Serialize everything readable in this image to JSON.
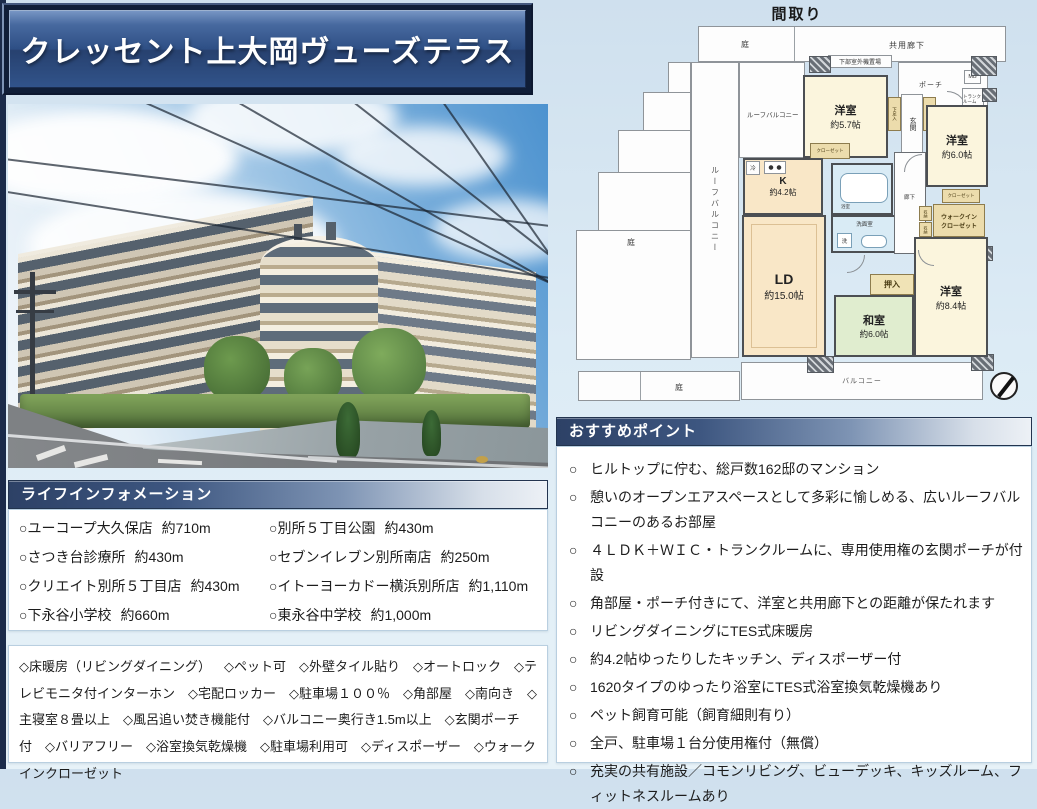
{
  "title_banner": "クレッセント上大岡ヴューズテラス",
  "floorplan": {
    "title": "間取り",
    "labels": {
      "garden": "庭",
      "common_corridor": "共用廊下",
      "outdoor_unit": "下部室外機置場",
      "porch": "ポーチ",
      "mb": "MB",
      "trunk_room": "トランクルーム",
      "roof_balcony": "ルーフバルコニー",
      "balcony": "バルコニー",
      "entrance": "玄関",
      "shoe_box": "下足入",
      "hallway": "廊下",
      "toilet": "トイレ",
      "bath": "浴室",
      "washroom": "洗面室",
      "washer": "洗",
      "fridge": "冷",
      "storage": "収納",
      "closet": "クローゼット",
      "wic_line1": "ウォークイン",
      "wic_line2": "クローゼット",
      "oshiire": "押入"
    },
    "rooms": {
      "western1": {
        "name": "洋室",
        "size": "約5.7帖"
      },
      "western2": {
        "name": "洋室",
        "size": "約6.0帖"
      },
      "western3": {
        "name": "洋室",
        "size": "約8.4帖"
      },
      "japanese": {
        "name": "和室",
        "size": "約6.0帖"
      },
      "kitchen": {
        "name": "K",
        "size": "約4.2帖"
      },
      "ld": {
        "name": "LD",
        "size": "約15.0帖"
      }
    }
  },
  "life_info": {
    "header": "ライフインフォメーション",
    "bullet": "○",
    "left": [
      {
        "name": "ユーコープ大久保店",
        "distance": "約710m"
      },
      {
        "name": "さつき台診療所",
        "distance": "約430m"
      },
      {
        "name": "クリエイト別所５丁目店",
        "distance": "約430m"
      },
      {
        "name": "下永谷小学校",
        "distance": "約660m"
      }
    ],
    "right": [
      {
        "name": "別所５丁目公園",
        "distance": "約430m"
      },
      {
        "name": "セブンイレブン別所南店",
        "distance": "約250m"
      },
      {
        "name": "イトーヨーカドー横浜別所店",
        "distance": "約1,110m"
      },
      {
        "name": "東永谷中学校",
        "distance": "約1,000m"
      }
    ]
  },
  "features": {
    "items": [
      "◇床暖房（リビングダイニング）",
      "◇ペット可",
      "◇外壁タイル貼り",
      "◇オートロック",
      "◇テレビモニタ付インターホン",
      "◇宅配ロッカー",
      "◇駐車場１００％",
      "◇角部屋",
      "◇南向き",
      "◇主寝室８畳以上",
      "◇風呂追い焚き機能付",
      "◇バルコニー奥行き1.5m以上",
      "◇玄関ポーチ付",
      "◇バリアフリー",
      "◇浴室換気乾燥機",
      "◇駐車場利用可",
      "◇ディスポーザー",
      "◇ウォークインクローゼット"
    ]
  },
  "recommend": {
    "header": "おすすめポイント",
    "bullet": "○",
    "points": [
      "ヒルトップに佇む、総戸数162邸のマンション",
      "憩いのオープンエアスペースとして多彩に愉しめる、広いルーフバルコニーのあるお部屋",
      "４ＬＤＫ＋ＷＩＣ・トランクルームに、専用使用権の玄関ポーチが付設",
      "角部屋・ポーチ付きにて、洋室と共用廊下との距離が保たれます",
      "リビングダイニングにTES式床暖房",
      "約4.2帖ゆったりしたキッチン、ディスポーザー付",
      "1620タイプのゆったり浴室にTES式浴室換気乾燥機あり",
      "ペット飼育可能（飼育細則有り）",
      "全戸、駐車場１台分使用権付（無償）",
      "充実の共有施設／コモンリビング、ビューデッキ、キッズルーム、フィットネスルームあり"
    ]
  },
  "colors": {
    "accent_navy": "#2d4166",
    "banner_blue": "#2e4f85",
    "room_cream": "#fbf5dd",
    "room_peach": "#f9e7c7",
    "room_green": "#e0edcf",
    "room_blue": "#d9ebf5",
    "closet_tan": "#ecdcac"
  }
}
